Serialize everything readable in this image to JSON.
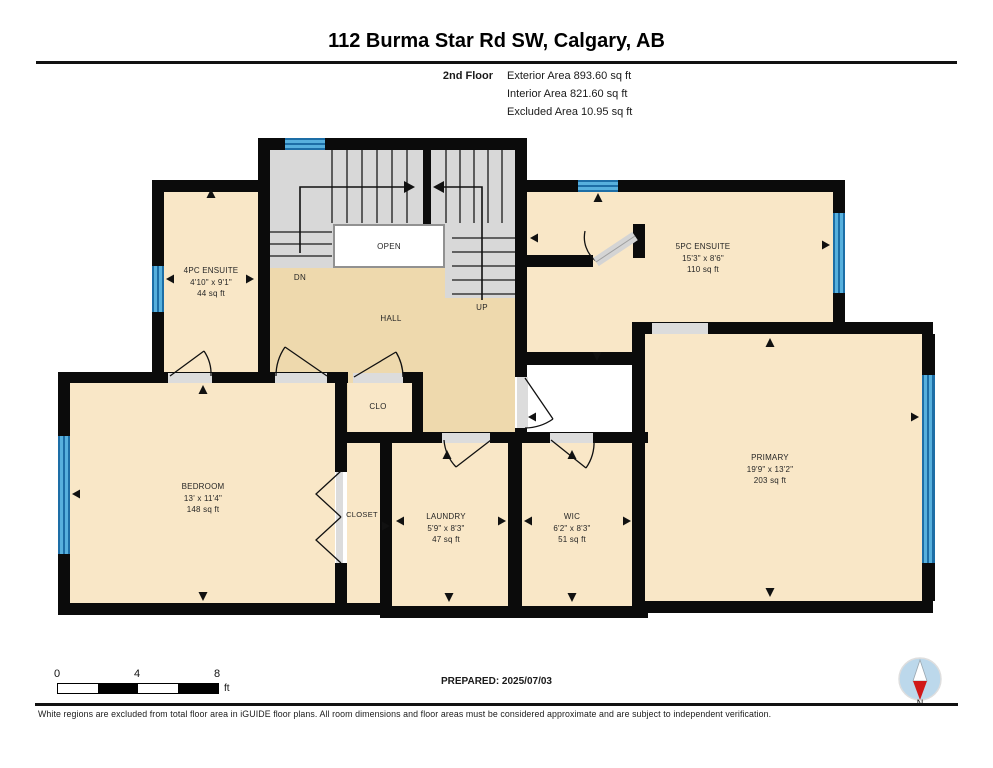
{
  "title": "112 Burma Star Rd SW, Calgary, AB",
  "header": {
    "floor": "2nd Floor",
    "area_lines": [
      "Exterior Area 893.60 sq ft",
      "Interior Area 821.60 sq ft",
      "Excluded Area 10.95 sq ft"
    ]
  },
  "rooms": {
    "ensuite4": {
      "name": "4PC ENSUITE",
      "dims": "4'10\" x 9'1\"",
      "area": "44 sq ft"
    },
    "ensuite5": {
      "name": "5PC ENSUITE",
      "dims": "15'3\" x 8'6\"",
      "area": "110 sq ft"
    },
    "bedroom": {
      "name": "BEDROOM",
      "dims": "13' x 11'4\"",
      "area": "148 sq ft"
    },
    "primary": {
      "name": "PRIMARY",
      "dims": "19'9\" x 13'2\"",
      "area": "203 sq ft"
    },
    "laundry": {
      "name": "LAUNDRY",
      "dims": "5'9\" x 8'3\"",
      "area": "47 sq ft"
    },
    "wic": {
      "name": "WIC",
      "dims": "6'2\" x 8'3\"",
      "area": "51 sq ft"
    },
    "clo": {
      "name": "CLO"
    },
    "closet": {
      "name": "CLOSET"
    },
    "hall": {
      "name": "HALL"
    }
  },
  "stairs": {
    "open": "OPEN",
    "down": "DN",
    "up": "UP"
  },
  "scale_bar": {
    "ticks": [
      "0",
      "4",
      "8"
    ],
    "unit": "ft"
  },
  "prepared": "PREPARED: 2025/07/03",
  "compass": {
    "label": "N"
  },
  "footer": "White regions are excluded from total floor area in iGUIDE floor plans. All room dimensions and floor areas must be considered approximate and are subject to independent verification.",
  "colors": {
    "wall": "#0b0b0b",
    "room_fill": "#f9e7c7",
    "hall_fill": "#eed9ad",
    "stair_gray": "#d8d8d8",
    "window_blue": "#57b0dd",
    "compass_blue": "#bcd8eb",
    "compass_red": "#d01818"
  }
}
